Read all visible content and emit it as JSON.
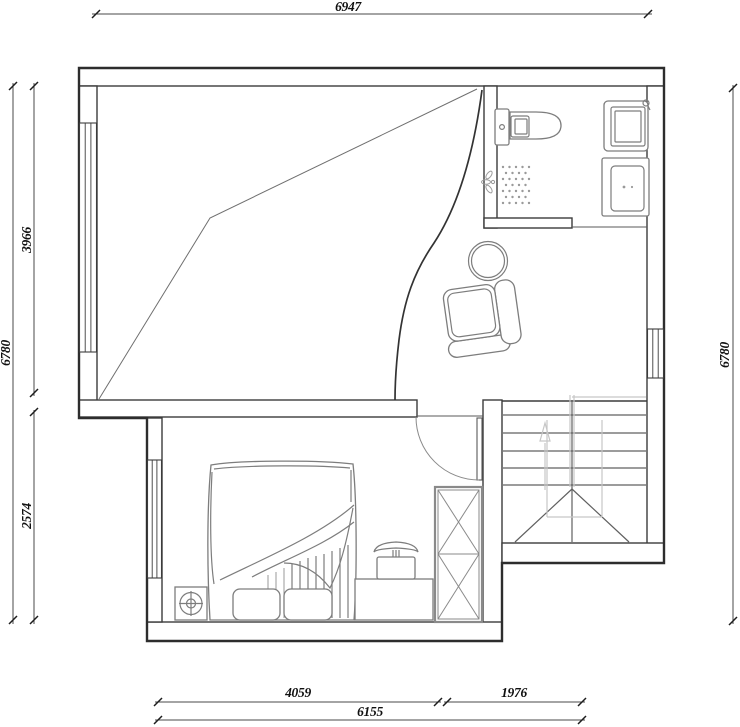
{
  "drawing": {
    "type": "architectural floor plan, attic level",
    "units": "mm",
    "dimensions": {
      "top": "6947",
      "left_total": "6780",
      "left_upper": "3966",
      "left_lower": "2574",
      "right_total": "6780",
      "bottom_left": "4059",
      "bottom_right": "1976",
      "bottom_total": "6155"
    },
    "symbols": [
      "sloped-ceiling-lines",
      "curved-partition",
      "window",
      "door-swing",
      "toilet",
      "shower-spray",
      "washbasin",
      "washing-machine",
      "round-table",
      "armchair",
      "double-bed",
      "pillow",
      "floor-lamp",
      "tv-on-cabinet",
      "wardrobe-x",
      "staircase-up-arrow"
    ],
    "colors": {
      "background": "#ffffff",
      "outer_wall_line": "#2d2d2d",
      "wall_line": "#3c3c3c",
      "furniture_line": "#7d7d7d",
      "stair_guide_line": "#c6c6c6",
      "dimension_line": "#4a4a4a",
      "dimension_text": "#111111"
    }
  }
}
